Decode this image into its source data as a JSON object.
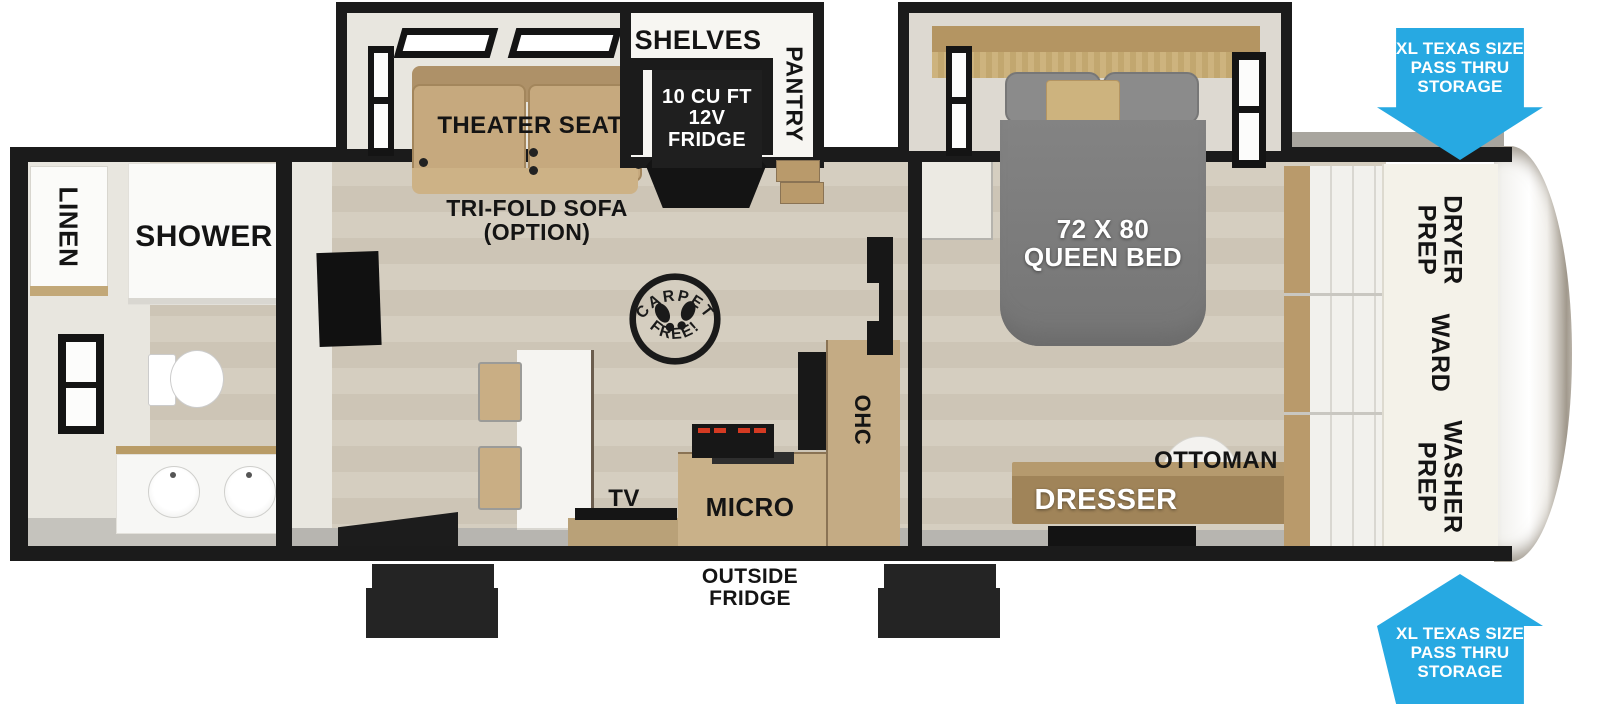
{
  "floorplan": {
    "bathroom": {
      "linen": "LINEN",
      "shower": "SHOWER"
    },
    "living": {
      "theater_seat": "THEATER SEAT",
      "trifold_sofa": "TRI-FOLD SOFA\n(OPTION)",
      "tv": "TV",
      "carpet_stamp_top": "CARPET",
      "carpet_stamp_bottom": "FREE!"
    },
    "kitchen": {
      "shelves": "SHELVES",
      "fridge": "10 CU FT\n12V\nFRIDGE",
      "pantry": "PANTRY",
      "micro": "MICRO",
      "ohc": "OHC",
      "outside_fridge": "OUTSIDE\nFRIDGE"
    },
    "bedroom": {
      "queen_bed": "72 X 80\nQUEEN BED",
      "dresser": "DRESSER",
      "ottoman": "OTTOMAN"
    },
    "wardrobe": {
      "dryer_prep": "DRYER\nPREP",
      "ward": "WARD",
      "washer_prep": "WASHER\nPREP"
    },
    "storage": {
      "pass_thru_top": "XL TEXAS SIZE\nPASS THRU\nSTORAGE",
      "pass_thru_bottom": "XL TEXAS SIZE\nPASS THRU\nSTORAGE"
    }
  },
  "colors": {
    "accent_blue": "#27A9E2",
    "wall_black": "#1B1B1B",
    "floor_wood": "#D3CBBD",
    "seat_tan": "#C6A97E",
    "bed_gray": "#7C7C7C",
    "cabinet_wood": "#C3A878",
    "counter_white": "#F5F4F1"
  }
}
